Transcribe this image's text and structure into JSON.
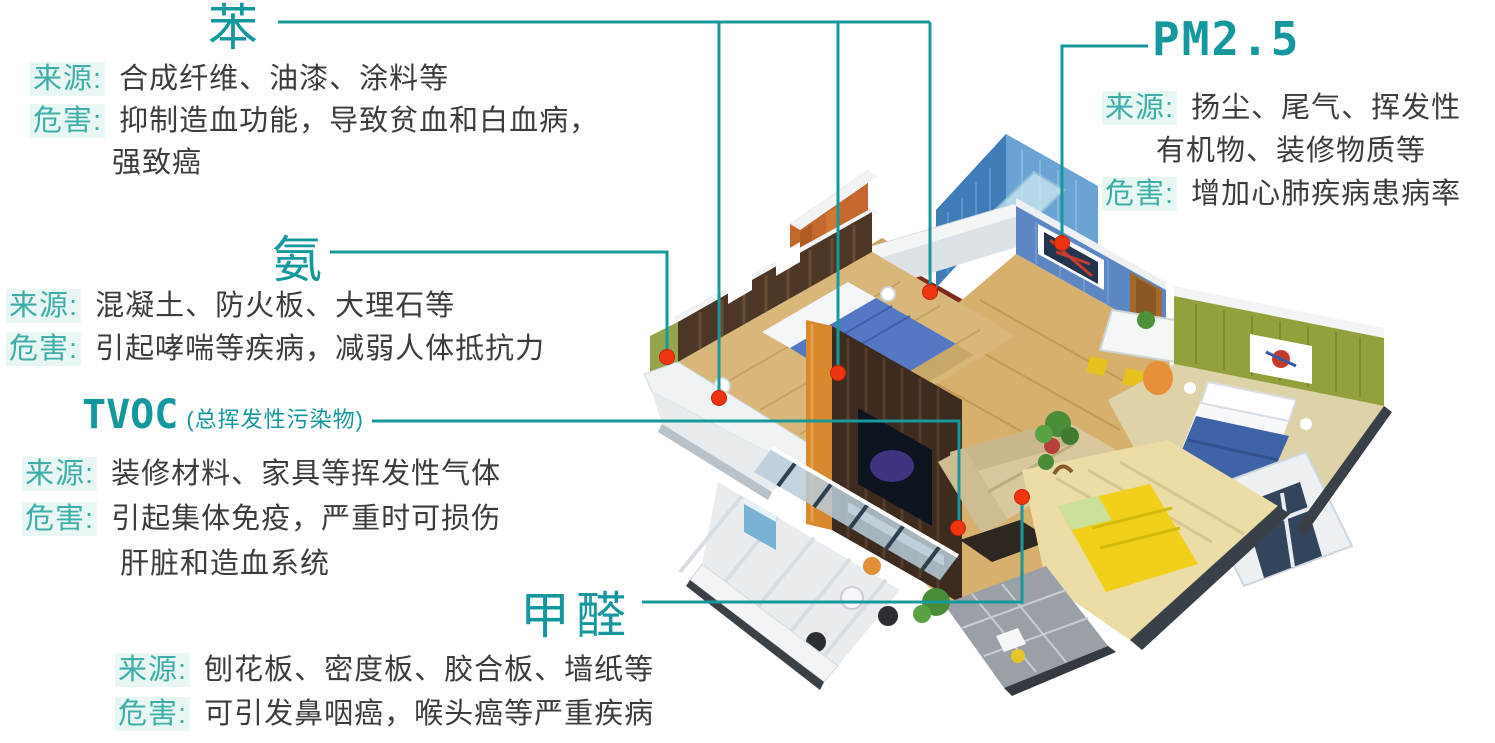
{
  "colors": {
    "accent_teal": "#17999b",
    "title_teal": "#14989d",
    "label_teal": "#3fada8",
    "label_bg": "#e8f6f4",
    "body_text": "#3c3c3c",
    "marker_red": "#ee3511"
  },
  "callouts": {
    "benzene": {
      "title": "苯",
      "source_label": "来源:",
      "source": "合成纤维、油漆、涂料等",
      "hazard_label": "危害:",
      "hazard_line1": "抑制造血功能，导致贫血和白血病，",
      "hazard_line2": "强致癌"
    },
    "ammonia": {
      "title": "氨",
      "source_label": "来源:",
      "source": "混凝土、防火板、大理石等",
      "hazard_label": "危害:",
      "hazard": "引起哮喘等疾病，减弱人体抵抗力"
    },
    "tvoc": {
      "title": "TVOC",
      "subtitle": "(总挥发性污染物)",
      "source_label": "来源:",
      "source": "装修材料、家具等挥发性气体",
      "hazard_label": "危害:",
      "hazard_line1": "引起集体免疫，严重时可损伤",
      "hazard_line2": "肝脏和造血系统"
    },
    "formaldehyde": {
      "title": "甲醛",
      "source_label": "来源:",
      "source": "刨花板、密度板、胶合板、墙纸等",
      "hazard_label": "危害:",
      "hazard": "可引发鼻咽癌，喉头癌等严重疾病"
    },
    "pm25": {
      "title": "PM2.5",
      "source_label": "来源:",
      "source_line1": "扬尘、尾气、挥发性",
      "source_line2": "有机物、装修物质等",
      "hazard_label": "危害:",
      "hazard": "增加心肺疾病患病率"
    }
  },
  "illustration": {
    "description": "isometric 3D cutaway apartment with pollution point markers",
    "marker_count": 7
  }
}
